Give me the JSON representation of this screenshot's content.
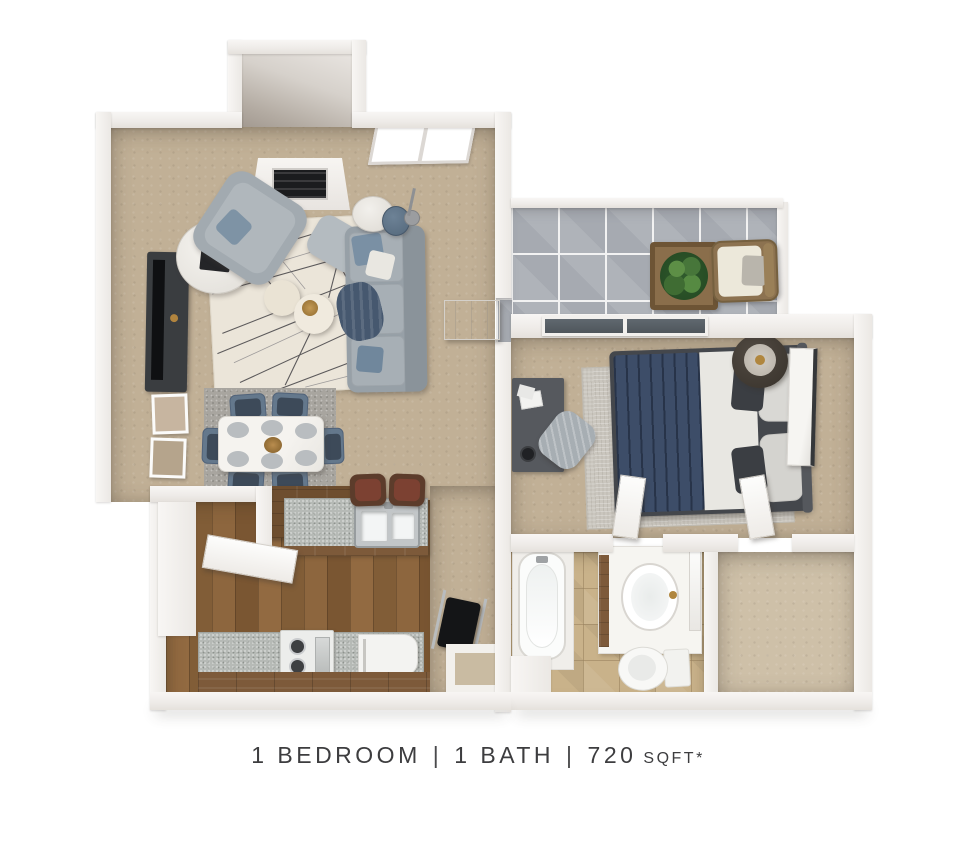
{
  "caption": {
    "bedroom": "1 BEDROOM",
    "separator": "|",
    "bath": "1 BATH",
    "area_value": "720",
    "area_unit": "SQFT*"
  },
  "plan": {
    "rooms": [
      {
        "name": "entry-vestibule",
        "floor": "concrete"
      },
      {
        "name": "living-room",
        "floor": "tan-carpet"
      },
      {
        "name": "dining-area",
        "floor": "tan-carpet"
      },
      {
        "name": "kitchen",
        "floor": "wood-plank"
      },
      {
        "name": "storage-closet",
        "floor": "wood-plank"
      },
      {
        "name": "entry-hall",
        "floor": "tan-carpet"
      },
      {
        "name": "patio",
        "floor": "gray-tile"
      },
      {
        "name": "bedroom",
        "floor": "tan-carpet"
      },
      {
        "name": "bathroom",
        "floor": "beige-tile"
      },
      {
        "name": "walk-in-closet",
        "floor": "tan-carpet"
      }
    ],
    "furniture": [
      "fireplace",
      "window",
      "tv-console",
      "wall-photos",
      "accent-table",
      "armchair",
      "ottoman",
      "area-rug",
      "poufs",
      "sofa",
      "floor-lamp",
      "drum-stool",
      "coffee-table",
      "dining-rug",
      "dining-table",
      "dining-chairs",
      "front-door",
      "bar-counter",
      "kitchen-sink",
      "bar-stools",
      "range",
      "dishwasher",
      "folding-chair",
      "storage-box",
      "potted-plant",
      "patio-chair",
      "sliding-glass-door",
      "bed",
      "bed-rug",
      "desk",
      "desk-chair",
      "nightstand",
      "table-lamp",
      "leaning-mirror",
      "bathtub",
      "vanity-sink",
      "mirror",
      "toilet",
      "bathroom-door",
      "closet-door",
      "storage-door"
    ]
  },
  "colors": {
    "background": "#ffffff",
    "wall": "#f3f1ee",
    "carpet": "#c1b096",
    "wood_floor": "#8a6039",
    "gray_tile": "#a6aab1",
    "beige_tile": "#c9b28a",
    "counter": "#b6bab6",
    "rug": "#ebe5d9",
    "sofa_gray": "#97a0a7",
    "navy": "#3d4d68",
    "plant_green": "#2f5a2c",
    "wicker": "#8c7250",
    "text": "#3d3d3f"
  }
}
